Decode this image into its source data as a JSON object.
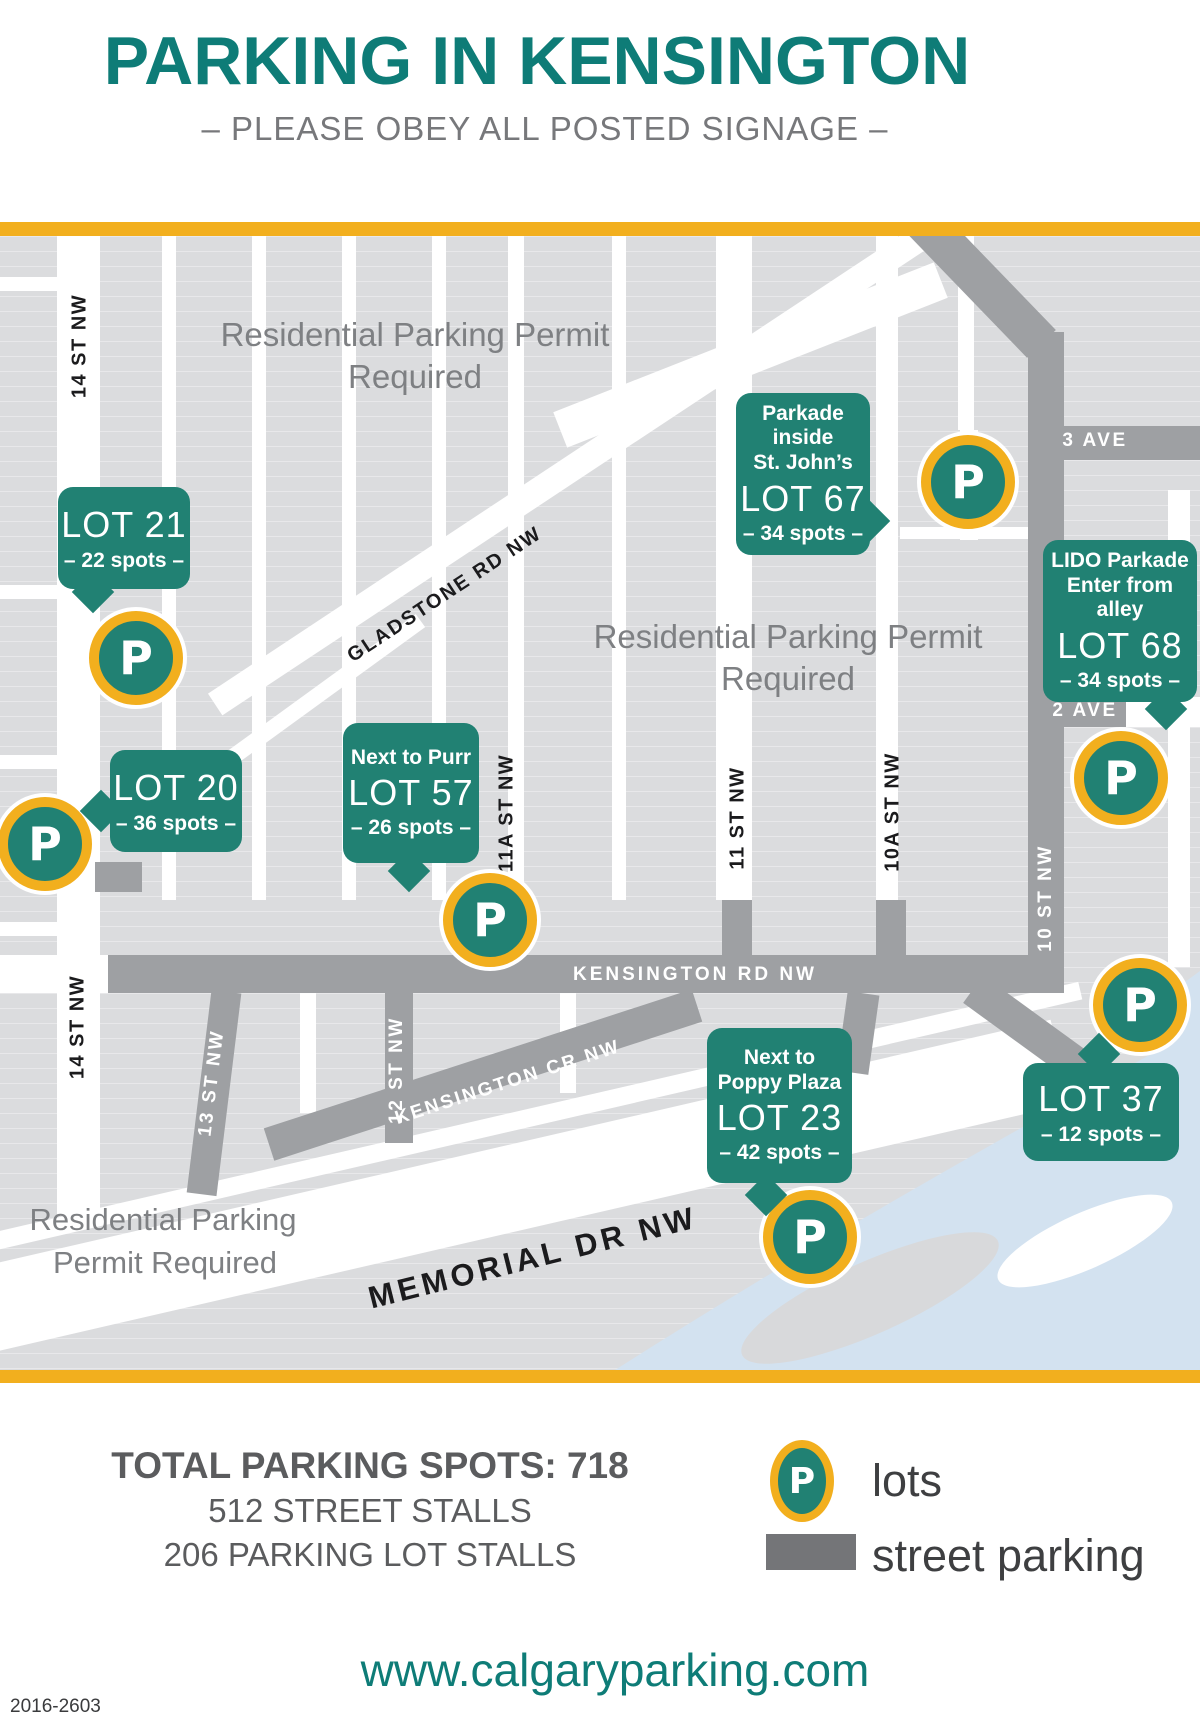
{
  "colors": {
    "teal_title": "#0E7C77",
    "teal_callout": "#218173",
    "yellow_accent": "#F2AF1E",
    "road_gray": "#9EA0A3",
    "block_gray": "#DBDCDE",
    "water_blue": "#D3E2F0",
    "permit_text_gray": "#7E8083",
    "footer_text_gray": "#5B5C5E"
  },
  "header": {
    "title": "PARKING IN KENSINGTON",
    "subtitle": "– PLEASE OBEY ALL POSTED SIGNAGE –"
  },
  "map": {
    "marker_letter": "P",
    "streets": {
      "st14_north": "14 ST NW",
      "st14_south": "14 ST NW",
      "st13": "13 ST NW",
      "st12": "12 ST NW",
      "st11a": "11A ST NW",
      "st11": "11 ST NW",
      "st10a": "10A ST NW",
      "st10": "10 ST NW",
      "gladstone": "GLADSTONE RD NW",
      "kensington_rd": "KENSINGTON RD NW",
      "kensington_cr": "KENSINGTON CR NW",
      "ave3": "3 AVE",
      "ave2": "2 AVE",
      "memorial": "MEMORIAL DR NW"
    },
    "permits": {
      "top": [
        "Residential Parking Permit",
        "Required"
      ],
      "middle": [
        "Residential Parking Permit",
        "Required"
      ],
      "bottom": [
        "Residential Parking",
        "Permit Required"
      ]
    },
    "lots": [
      {
        "name": "LOT 21",
        "spots": "– 22 spots –"
      },
      {
        "name": "LOT 20",
        "spots": "– 36 spots –"
      },
      {
        "note1": "Next to Purr",
        "name": "LOT 57",
        "spots": "– 26 spots –"
      },
      {
        "note1": "Parkade inside",
        "note2": "St. John’s",
        "name": "LOT 67",
        "spots": "– 34 spots –"
      },
      {
        "note1": "LIDO Parkade",
        "note2": "Enter from alley",
        "name": "LOT 68",
        "spots": "– 34 spots –"
      },
      {
        "note1": "Next to",
        "note2": "Poppy Plaza",
        "name": "LOT 23",
        "spots": "– 42 spots –"
      },
      {
        "name": "LOT 37",
        "spots": "– 12 spots –"
      }
    ]
  },
  "legend": {
    "p_letter": "P",
    "lots_label": "lots",
    "street_label": "street parking"
  },
  "totals": {
    "title": "TOTAL PARKING SPOTS: 718",
    "street": "512 STREET STALLS",
    "lot": "206 PARKING LOT STALLS"
  },
  "footer": {
    "url": "www.calgaryparking.com",
    "code": "2016-2603"
  }
}
